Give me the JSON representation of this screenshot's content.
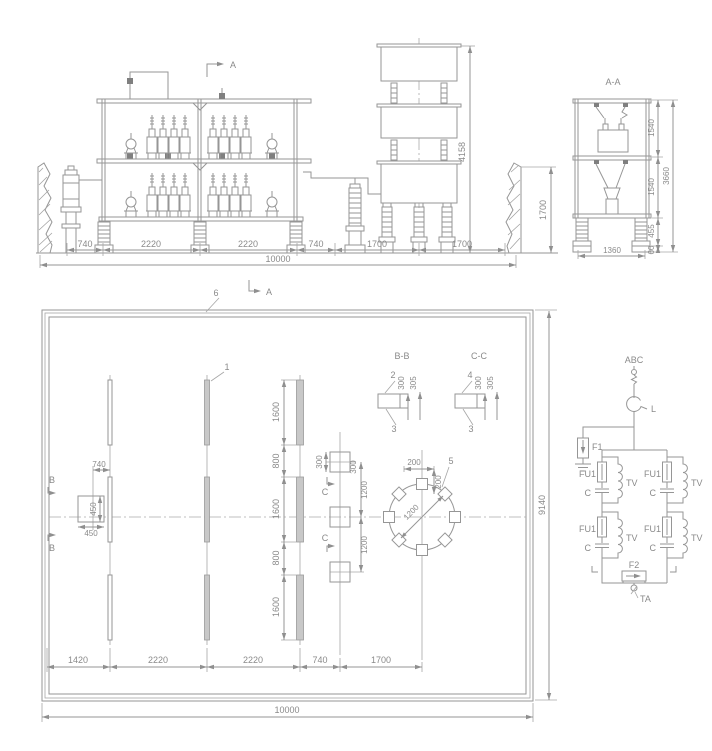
{
  "colors": {
    "line": "#969696",
    "text": "#8a8a8a",
    "pad_fill": "#c8c8c8",
    "background": "#ffffff"
  },
  "elevation": {
    "section_marker": "A",
    "dims_bottom": [
      "740",
      "2220",
      "2220",
      "740",
      "1700",
      "1700"
    ],
    "dim_total": "10000",
    "dim_reactor_height": "4158",
    "dim_wall_height": "1700"
  },
  "section_aa": {
    "title": "A-A",
    "dim_tier1": "1540",
    "dim_tier2": "1540",
    "dim_support": "455",
    "dim_base": "60",
    "dim_total_height": "3660",
    "dim_width": "1360"
  },
  "plan": {
    "label_enclosure": "6",
    "label_rail": "1",
    "label_pad": "5",
    "marker_b": "B",
    "marker_c": "C",
    "dim_offset_b": "740",
    "dim_square_b_w": "450",
    "dim_square_b_h": "450",
    "dim_square_c_h": "300",
    "dim_square_c_w": "300",
    "dim_c_pitch_upper": "1200",
    "dim_c_pitch_lower": "1200",
    "dim_circle_off_x": "200",
    "dim_circle_off_y": "200",
    "dim_circle_dia": "1200",
    "dims_rail": [
      "1600",
      "800",
      "1600",
      "800",
      "1600"
    ],
    "dims_bottom": [
      "1420",
      "2220",
      "2220",
      "740",
      "1700"
    ],
    "dim_total": "10000",
    "dim_side": "9140"
  },
  "detail_bb": {
    "title": "B-B",
    "callout_top": "2",
    "callout_bottom": "3",
    "dim_a": "300",
    "dim_b": "305"
  },
  "detail_cc": {
    "title": "C-C",
    "callout_top": "4",
    "callout_bottom": "3",
    "dim_a": "300",
    "dim_b": "305"
  },
  "schematic": {
    "bus_label": "ABC",
    "reactor_label": "L",
    "arrester_label": "F1",
    "spark_gap_label": "F2",
    "fuse_label": "FU1",
    "capacitor_label": "C",
    "transformer_label": "TV",
    "ct_label": "TA"
  }
}
